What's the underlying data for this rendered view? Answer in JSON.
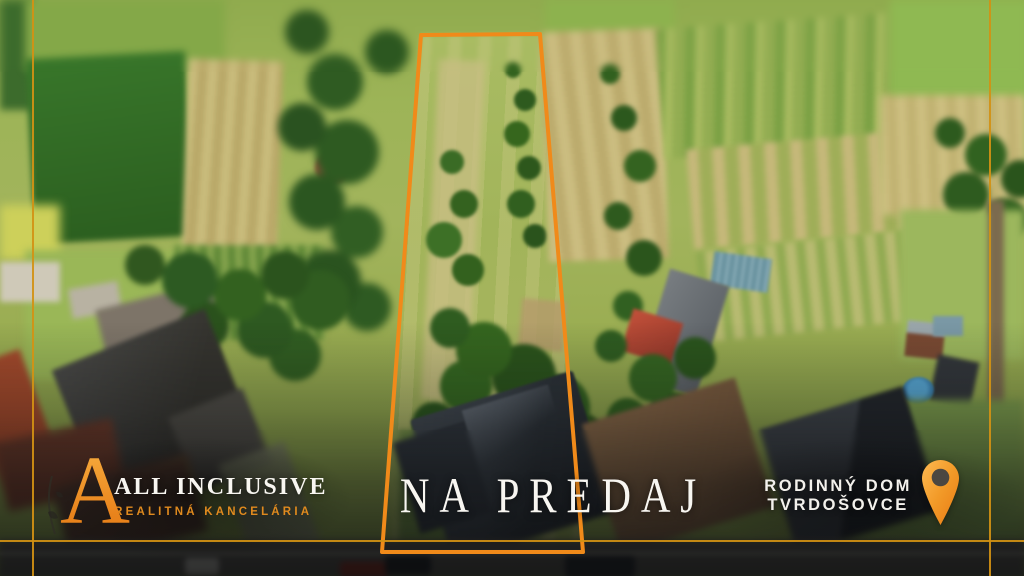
{
  "branding": {
    "agency_initial": "A",
    "agency_name": "ALL INCLUSIVE",
    "agency_subtitle": "REALITNÁ KANCELÁRIA"
  },
  "banner": {
    "status_text": "NA PREDAJ"
  },
  "property": {
    "type_label": "RODINNÝ DOM",
    "location_label": "TVRDOŠOVCE",
    "pin_icon": "location-pin-icon"
  },
  "property_outline": {
    "points": "421,35 540,34 583,552 382,552",
    "stroke_color": "#F08A1A"
  },
  "frame": {
    "line_color": "#D39114"
  },
  "colors": {
    "accent_orange": "#F0941E",
    "text_white": "#F8F6F1",
    "overlay_dark": "rgba(8,9,11,0.78)"
  }
}
